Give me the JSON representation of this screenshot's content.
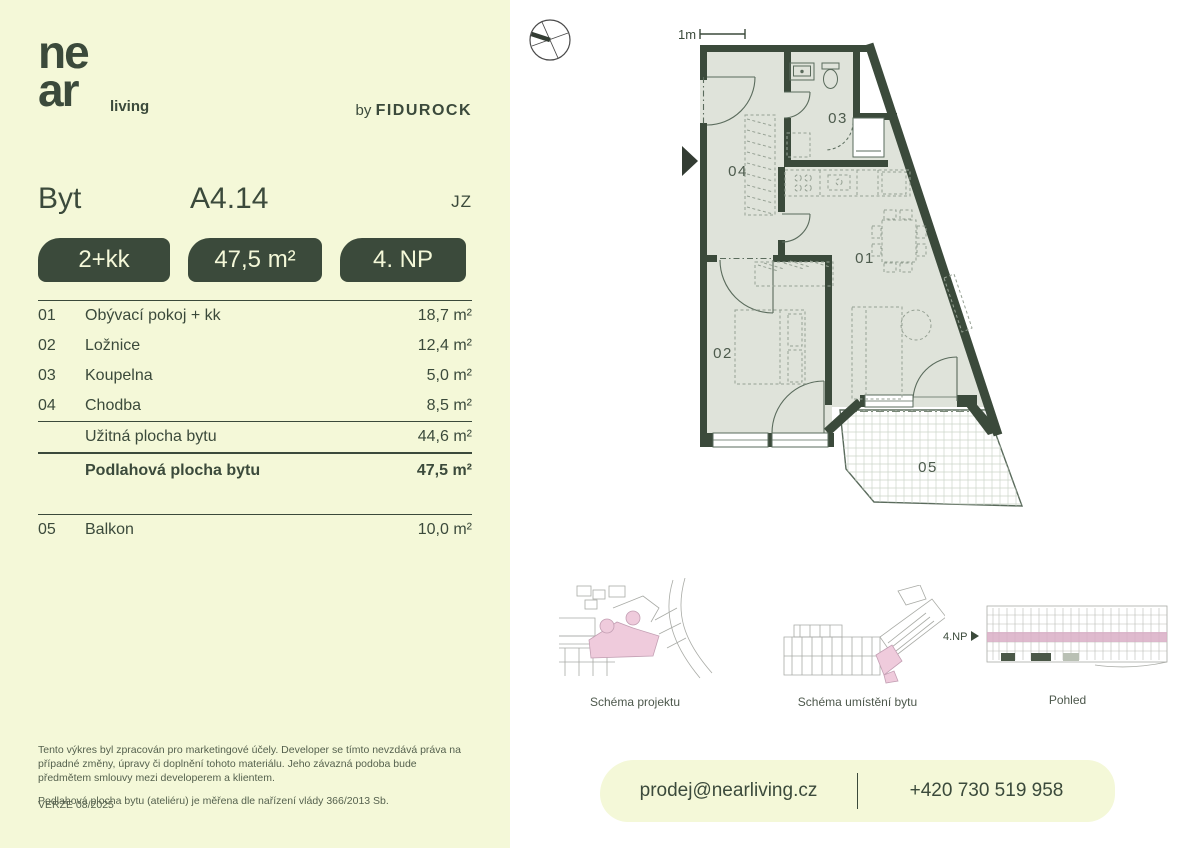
{
  "brand": {
    "logo_line1": "ne",
    "logo_line2": "ar",
    "logo_suffix": "living",
    "byline_prefix": "by",
    "byline_brand": "FIDUROCK"
  },
  "header": {
    "label": "Byt",
    "unit_id": "A4.14",
    "orientation": "JZ"
  },
  "badges": [
    {
      "label": "2+kk"
    },
    {
      "label": "47,5 m²"
    },
    {
      "label": "4. NP"
    }
  ],
  "rooms": [
    {
      "num": "01",
      "name": "Obývací pokoj + kk",
      "area": "18,7 m²"
    },
    {
      "num": "02",
      "name": "Ložnice",
      "area": "12,4 m²"
    },
    {
      "num": "03",
      "name": "Koupelna",
      "area": "5,0 m²"
    },
    {
      "num": "04",
      "name": "Chodba",
      "area": "8,5 m²"
    }
  ],
  "summary": [
    {
      "name": "Užitná plocha bytu",
      "area": "44,6 m²"
    },
    {
      "name": "Podlahová plocha bytu",
      "area": "47,5 m²"
    }
  ],
  "extra_rooms": [
    {
      "num": "05",
      "name": "Balkon",
      "area": "10,0 m²"
    }
  ],
  "disclaimer": {
    "p1": "Tento výkres byl zpracován pro marketingové účely. Developer se tímto nevzdává práva na případné změny, úpravy či doplnění tohoto materiálu. Jeho závazná podoba bude předmětem smlouvy mezi developerem a klientem.",
    "p2": "Podlahová plocha bytu (ateliéru) je měřena dle nařízení vlády 366/2013 Sb."
  },
  "version": "VERZE 08/2025",
  "plan": {
    "scale_label": "1m",
    "labels": {
      "r01": "01",
      "r02": "02",
      "r03": "03",
      "r04": "04",
      "r05": "05"
    }
  },
  "schematics": {
    "fig1_caption": "Schéma projektu",
    "fig2_caption": "Schéma umístění bytu",
    "fig3_caption": "Pohled",
    "floor_label": "4.NP"
  },
  "contact": {
    "email": "prodej@nearliving.cz",
    "phone": "+420 730 519 958"
  },
  "colors": {
    "panel": "#F4F8D8",
    "accent_green": "#3B4A3B",
    "floor_fill": "#DFE3DA",
    "plan_line": "#5a6b5c",
    "highlight_pink": "#EFCBDC",
    "elevation_stripe": "#D9AEC6"
  }
}
